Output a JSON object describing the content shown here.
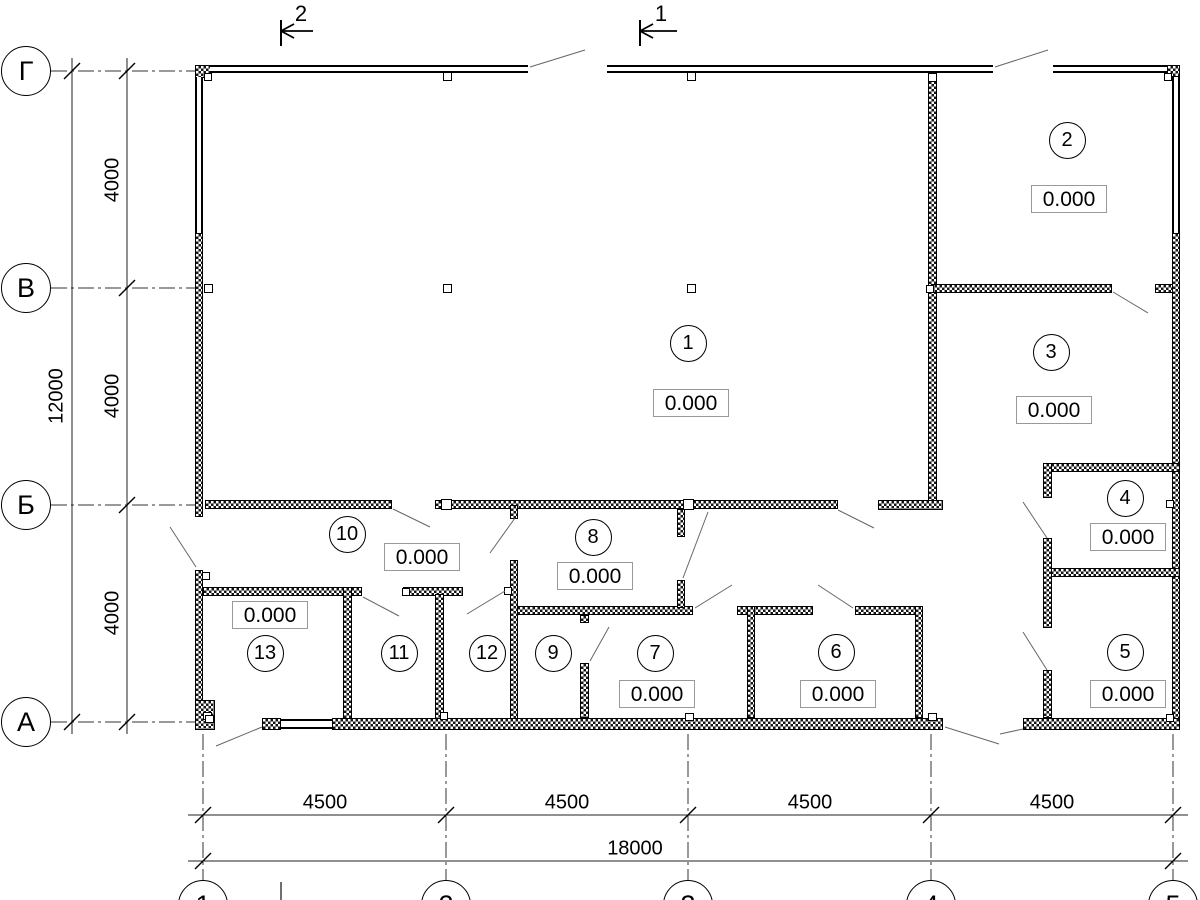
{
  "drawing": {
    "elevation_value": "0.000",
    "colors": {
      "wall": "#000000",
      "dim_line": "#333333",
      "leader": "#666666",
      "box_border": "#999999"
    }
  },
  "axes": {
    "rows": [
      {
        "label": "Г",
        "cx": 26,
        "cy": 71
      },
      {
        "label": "В",
        "cx": 26,
        "cy": 288
      },
      {
        "label": "Б",
        "cx": 26,
        "cy": 505
      },
      {
        "label": "А",
        "cx": 26,
        "cy": 722
      }
    ],
    "cols": [
      {
        "label": "1",
        "cx": 203,
        "cy": 905
      },
      {
        "label": "2",
        "cx": 446,
        "cy": 905
      },
      {
        "label": "3",
        "cx": 688,
        "cy": 905
      },
      {
        "label": "4",
        "cx": 931,
        "cy": 905
      },
      {
        "label": "5",
        "cx": 1173,
        "cy": 905
      }
    ]
  },
  "sections": [
    {
      "label": "2",
      "bar_x": 281,
      "y": 31,
      "line_to_x": 313,
      "text_x": 301,
      "text_y": 14
    },
    {
      "label": "1",
      "bar_x": 640,
      "y": 31,
      "line_to_x": 677,
      "text_x": 661,
      "text_y": 14
    }
  ],
  "dimensions": [
    {
      "text": "4000",
      "x": 113,
      "y": 180,
      "rot": true
    },
    {
      "text": "4000",
      "x": 113,
      "y": 396,
      "rot": true
    },
    {
      "text": "4000",
      "x": 113,
      "y": 613,
      "rot": true
    },
    {
      "text": "12000",
      "x": 57,
      "y": 396,
      "rot": true
    },
    {
      "text": "4500",
      "x": 325,
      "y": 803,
      "rot": false
    },
    {
      "text": "4500",
      "x": 567,
      "y": 803,
      "rot": false
    },
    {
      "text": "4500",
      "x": 810,
      "y": 803,
      "rot": false
    },
    {
      "text": "4500",
      "x": 1052,
      "y": 803,
      "rot": false
    },
    {
      "text": "18000",
      "x": 635,
      "y": 849,
      "rot": false
    }
  ],
  "rooms": [
    {
      "number": "1",
      "cx": 688,
      "cy": 343,
      "elev": "0.000",
      "bx": 691,
      "by": 403
    },
    {
      "number": "2",
      "cx": 1067,
      "cy": 140,
      "elev": "0.000",
      "bx": 1069,
      "by": 199
    },
    {
      "number": "3",
      "cx": 1051,
      "cy": 352,
      "elev": "0.000",
      "bx": 1054,
      "by": 410
    },
    {
      "number": "4",
      "cx": 1125,
      "cy": 498,
      "elev": "0.000",
      "bx": 1128,
      "by": 537
    },
    {
      "number": "5",
      "cx": 1125,
      "cy": 652,
      "elev": "0.000",
      "bx": 1128,
      "by": 694
    },
    {
      "number": "6",
      "cx": 836,
      "cy": 652,
      "elev": "0.000",
      "bx": 838,
      "by": 694
    },
    {
      "number": "7",
      "cx": 655,
      "cy": 653,
      "elev": "0.000",
      "bx": 657,
      "by": 694
    },
    {
      "number": "8",
      "cx": 593,
      "cy": 537,
      "elev": "0.000",
      "bx": 595,
      "by": 576
    },
    {
      "number": "9",
      "cx": 553,
      "cy": 653
    },
    {
      "number": "10",
      "cx": 347,
      "cy": 534,
      "elev": "0.000",
      "bx": 422,
      "by": 557
    },
    {
      "number": "11",
      "cx": 399,
      "cy": 653
    },
    {
      "number": "12",
      "cx": 487,
      "cy": 653
    },
    {
      "number": "13",
      "cx": 265,
      "cy": 653,
      "elev": "0.000",
      "bx": 270,
      "by": 615
    }
  ],
  "plan": {
    "walls": [
      [
        195,
        65,
        16,
        13
      ],
      [
        1167,
        65,
        13,
        12
      ],
      [
        195,
        233,
        8,
        284
      ],
      [
        195,
        570,
        8,
        158
      ],
      [
        1172,
        233,
        8,
        495
      ],
      [
        928,
        73,
        9,
        430
      ],
      [
        205,
        500,
        187,
        9
      ],
      [
        435,
        500,
        403,
        9
      ],
      [
        878,
        500,
        65,
        10
      ],
      [
        931,
        284,
        181,
        9
      ],
      [
        1155,
        284,
        18,
        9
      ],
      [
        1043,
        463,
        137,
        9
      ],
      [
        1045,
        568,
        135,
        9
      ],
      [
        1043,
        463,
        9,
        35
      ],
      [
        1043,
        538,
        9,
        90
      ],
      [
        1043,
        670,
        9,
        48
      ],
      [
        514,
        606,
        179,
        9
      ],
      [
        737,
        606,
        76,
        9
      ],
      [
        855,
        606,
        68,
        9
      ],
      [
        203,
        587,
        159,
        9
      ],
      [
        403,
        587,
        60,
        9
      ],
      [
        343,
        587,
        9,
        141
      ],
      [
        435,
        594,
        9,
        134
      ],
      [
        510,
        505,
        8,
        14
      ],
      [
        510,
        560,
        8,
        168
      ],
      [
        580,
        615,
        9,
        8
      ],
      [
        580,
        663,
        9,
        55
      ],
      [
        677,
        509,
        8,
        28
      ],
      [
        677,
        580,
        8,
        28
      ],
      [
        747,
        606,
        8,
        112
      ],
      [
        915,
        606,
        8,
        112
      ],
      [
        195,
        700,
        20,
        30
      ],
      [
        262,
        718,
        19,
        12
      ],
      [
        332,
        718,
        611,
        12
      ],
      [
        1023,
        718,
        157,
        12
      ]
    ],
    "windows_h": [
      [
        210,
        65,
        318,
        8
      ],
      [
        607,
        65,
        386,
        8
      ],
      [
        1053,
        65,
        114,
        8
      ]
    ],
    "windows_v": [
      [
        195,
        77,
        8,
        156
      ],
      [
        1172,
        77,
        8,
        156
      ]
    ],
    "sills": [
      [
        281,
        719,
        51,
        10
      ]
    ],
    "columns": [
      [
        204,
        73,
        8,
        8
      ],
      [
        443,
        72,
        9,
        9
      ],
      [
        687,
        72,
        9,
        9
      ],
      [
        928,
        73,
        9,
        9
      ],
      [
        1164,
        73,
        8,
        8
      ],
      [
        204,
        284,
        9,
        9
      ],
      [
        443,
        284,
        9,
        9
      ],
      [
        687,
        284,
        9,
        9
      ],
      [
        926,
        285,
        8,
        8
      ],
      [
        441,
        499,
        11,
        11
      ],
      [
        683,
        499,
        11,
        11
      ],
      [
        202,
        572,
        8,
        8
      ],
      [
        402,
        588,
        8,
        8
      ],
      [
        504,
        587,
        8,
        8
      ],
      [
        1166,
        500,
        8,
        8
      ],
      [
        1166,
        714,
        8,
        8
      ],
      [
        203,
        712,
        9,
        8
      ],
      [
        440,
        712,
        8,
        8
      ],
      [
        685,
        713,
        9,
        8
      ],
      [
        928,
        713,
        9,
        8
      ],
      [
        205,
        715,
        9,
        8
      ]
    ],
    "axis_lines": [
      [
        51,
        71,
        195,
        71
      ],
      [
        51,
        288,
        195,
        288
      ],
      [
        51,
        505,
        195,
        505
      ],
      [
        51,
        722,
        195,
        722
      ],
      [
        203,
        734,
        203,
        880
      ],
      [
        446,
        734,
        446,
        880
      ],
      [
        688,
        734,
        688,
        880
      ],
      [
        931,
        734,
        931,
        880
      ],
      [
        1173,
        734,
        1173,
        880
      ]
    ],
    "dim_lines": [
      [
        72,
        58,
        72,
        734
      ],
      [
        127,
        58,
        127,
        734
      ],
      [
        188,
        815,
        1188,
        815
      ],
      [
        188,
        861,
        1188,
        861
      ]
    ],
    "leaders": [
      [
        530,
        67,
        585,
        50
      ],
      [
        995,
        67,
        1048,
        50
      ],
      [
        1113,
        292,
        1148,
        313
      ],
      [
        838,
        510,
        874,
        528
      ],
      [
        393,
        509,
        430,
        527
      ],
      [
        170,
        527,
        196,
        567
      ],
      [
        363,
        597,
        399,
        616
      ],
      [
        467,
        614,
        505,
        591
      ],
      [
        590,
        661,
        609,
        627
      ],
      [
        683,
        578,
        708,
        512
      ],
      [
        695,
        608,
        732,
        585
      ],
      [
        818,
        585,
        853,
        608
      ],
      [
        945,
        727,
        999,
        744
      ],
      [
        1000,
        734,
        1023,
        729
      ],
      [
        216,
        746,
        262,
        727
      ],
      [
        1023,
        502,
        1047,
        538
      ],
      [
        1023,
        632,
        1047,
        670
      ],
      [
        490,
        553,
        515,
        518
      ]
    ],
    "extra_lines": [
      [
        281,
        882,
        281,
        900
      ]
    ],
    "ticks": [
      [
        72,
        71
      ],
      [
        72,
        722
      ],
      [
        127,
        71
      ],
      [
        127,
        288
      ],
      [
        127,
        505
      ],
      [
        127,
        722
      ],
      [
        203,
        815
      ],
      [
        446,
        815
      ],
      [
        688,
        815
      ],
      [
        931,
        815
      ],
      [
        1173,
        815
      ],
      [
        203,
        861
      ],
      [
        1173,
        861
      ]
    ]
  }
}
